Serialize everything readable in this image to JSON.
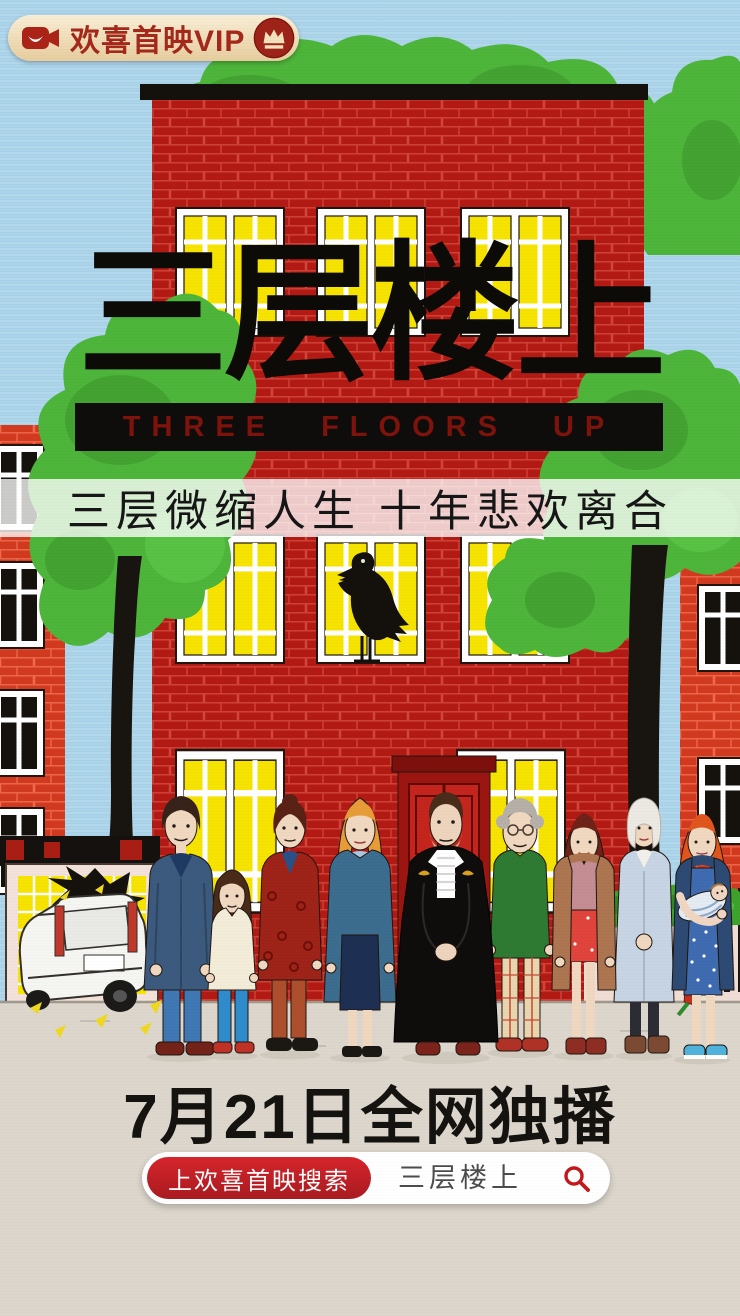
{
  "app_badge": {
    "label": "欢喜首映VIP"
  },
  "title": {
    "zh": "三层楼上",
    "en": "THREE FLOORS UP"
  },
  "tagline": "三层微缩人生 十年悲欢离合",
  "release_note": "7月21日全网独播",
  "search_bar": {
    "button_label": "上欢喜首映搜索",
    "query": "三层楼上"
  },
  "icons": {
    "badge_left": "video-camera-icon",
    "badge_right": "crown-icon",
    "search": "magnifier-icon"
  },
  "colors": {
    "sky": "#abd3e9",
    "brick_main": "#b31a14",
    "brick_side": "#d23a20",
    "foliage": "#4db53a",
    "window_yellow": "#f6e400",
    "title_black": "#0d0b08",
    "title_en_red": "#7e130c",
    "badge_bg": "#f4e6c4",
    "badge_text": "#a5291b",
    "search_red": "#c2191f",
    "ground": "#dcd6cc"
  }
}
